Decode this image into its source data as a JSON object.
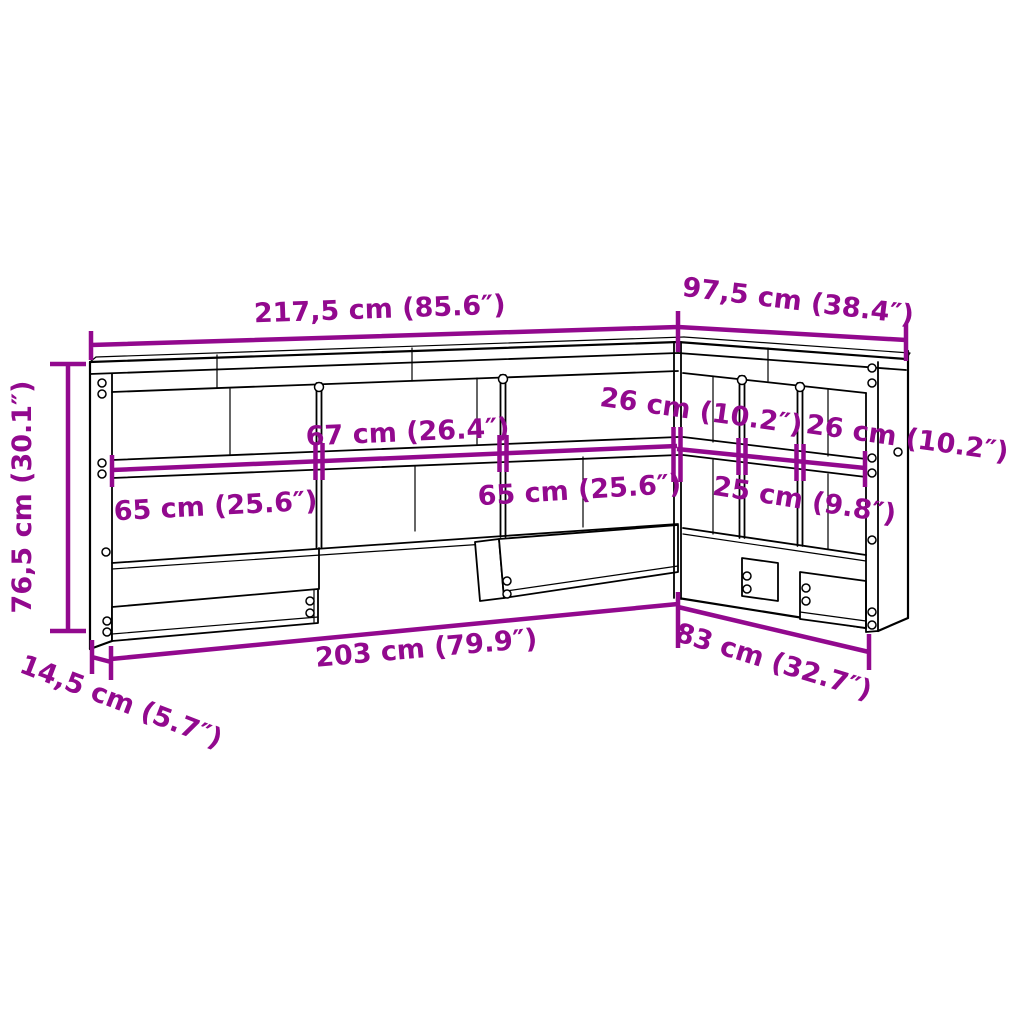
{
  "diagram": {
    "title": "L-shaped bookcase headboard dimension diagram",
    "accent_color": "#92098E",
    "line_color": "#000000",
    "background_color": "#FFFFFF",
    "labels": {
      "top_width": "217,5 cm (85.6″)",
      "side_width": "97,5 cm (38.4″)",
      "height": "76,5 cm (30.1″)",
      "depth": "14,5 cm (5.7″)",
      "bottom_width": "203 cm (79.9″)",
      "bottom_side_width": "83 cm (32.7″)",
      "shelf_left": "65 cm (25.6″)",
      "shelf_middle": "67 cm (26.4″)",
      "shelf_right": "65 cm (25.6″)",
      "side_shelf_first": "26 cm (10.2″)",
      "side_shelf_middle": "25 cm (9.8″)",
      "side_shelf_last": "26 cm (10.2″)"
    }
  }
}
